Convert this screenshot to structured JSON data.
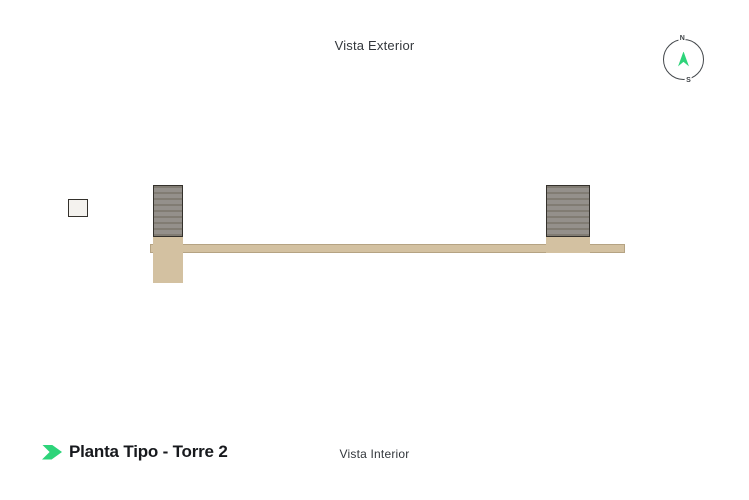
{
  "header": {
    "title": "Vista Exterior"
  },
  "footer": {
    "title": "Planta Tipo - Torre 2",
    "subtitle": "Vista Interior"
  },
  "compass": {
    "north": "N",
    "south": "S",
    "marker_icon": "navigation-arrow-icon"
  },
  "colors": {
    "accent": "#2ed47a",
    "wall": "#34312c",
    "floor": "#d7d0c6",
    "floor_alt": "#cfc7bb",
    "corridor": "#d3c1a1",
    "stair": "#94908b",
    "stair_tread": "#817c73",
    "wood": "#b48e5e",
    "counter": "#edeae5",
    "text_dark": "#17191d",
    "text_mid": "#33373c"
  },
  "floorplan": {
    "description": "Typical floor plan, Tower 2: 12 apartment units in two rows separated by a central corridor, with a stair core left of center and a stair/elevator core right of center.",
    "top_labels": [
      {
        "text": "119",
        "x": 58
      },
      {
        "text": "118",
        "x": 171
      },
      {
        "text": "117",
        "x": 261
      },
      {
        "text": "116",
        "x": 358
      },
      {
        "text": "115",
        "x": 448
      },
      {
        "text": "114",
        "x": 576
      }
    ],
    "bottom_labels": [
      {
        "text": "120",
        "x": 58
      },
      {
        "text": "121",
        "x": 171
      },
      {
        "text": "122",
        "x": 261
      },
      {
        "text": "123",
        "x": 356
      },
      {
        "text": "124",
        "x": 451
      },
      {
        "text": "113",
        "x": 573
      }
    ],
    "units": [
      {
        "id": "119",
        "row": "top",
        "rect": [
          3,
          0,
          93,
          59
        ],
        "wing": [
          0,
          25,
          50,
          40
        ]
      },
      {
        "id": "118",
        "row": "top",
        "rect": [
          126,
          4,
          90,
          55
        ]
      },
      {
        "id": "117",
        "row": "top",
        "rect": [
          216,
          4,
          90,
          55
        ]
      },
      {
        "id": "116",
        "row": "top",
        "rect": [
          321,
          4,
          84,
          55
        ]
      },
      {
        "id": "115",
        "row": "top",
        "rect": [
          405,
          4,
          84,
          55
        ]
      },
      {
        "id": "114",
        "row": "top",
        "rect": [
          533,
          2,
          88,
          57
        ],
        "wing": [
          584,
          22,
          42,
          33
        ]
      },
      {
        "id": "120",
        "row": "bottom",
        "rect": [
          3,
          68,
          93,
          59
        ],
        "wing": [
          0,
          62,
          50,
          40
        ]
      },
      {
        "id": "121",
        "row": "bottom",
        "rect": [
          126,
          68,
          90,
          55
        ]
      },
      {
        "id": "122",
        "row": "bottom",
        "rect": [
          216,
          68,
          90,
          55
        ]
      },
      {
        "id": "123",
        "row": "bottom",
        "rect": [
          321,
          68,
          84,
          55
        ]
      },
      {
        "id": "124",
        "row": "bottom",
        "rect": [
          405,
          68,
          84,
          55
        ]
      },
      {
        "id": "113",
        "row": "bottom",
        "rect": [
          533,
          68,
          88,
          57
        ],
        "wing": [
          584,
          72,
          42,
          33
        ]
      }
    ],
    "corridor": {
      "rect": [
        93,
        59,
        475,
        9
      ]
    },
    "cores": {
      "left_stair": {
        "rect": [
          96,
          0,
          30,
          52
        ]
      },
      "left_lobby": {
        "rect": [
          96,
          52,
          30,
          46
        ]
      },
      "right_stair": {
        "rect": [
          489,
          0,
          44,
          52
        ]
      },
      "right_landing": {
        "rect": [
          500,
          14,
          20,
          18
        ]
      },
      "right_lobby": {
        "rect": [
          489,
          52,
          44,
          16
        ]
      },
      "elevators": [
        [
          503,
          70,
          27,
          22
        ],
        [
          503,
          94,
          27,
          22
        ]
      ]
    }
  }
}
